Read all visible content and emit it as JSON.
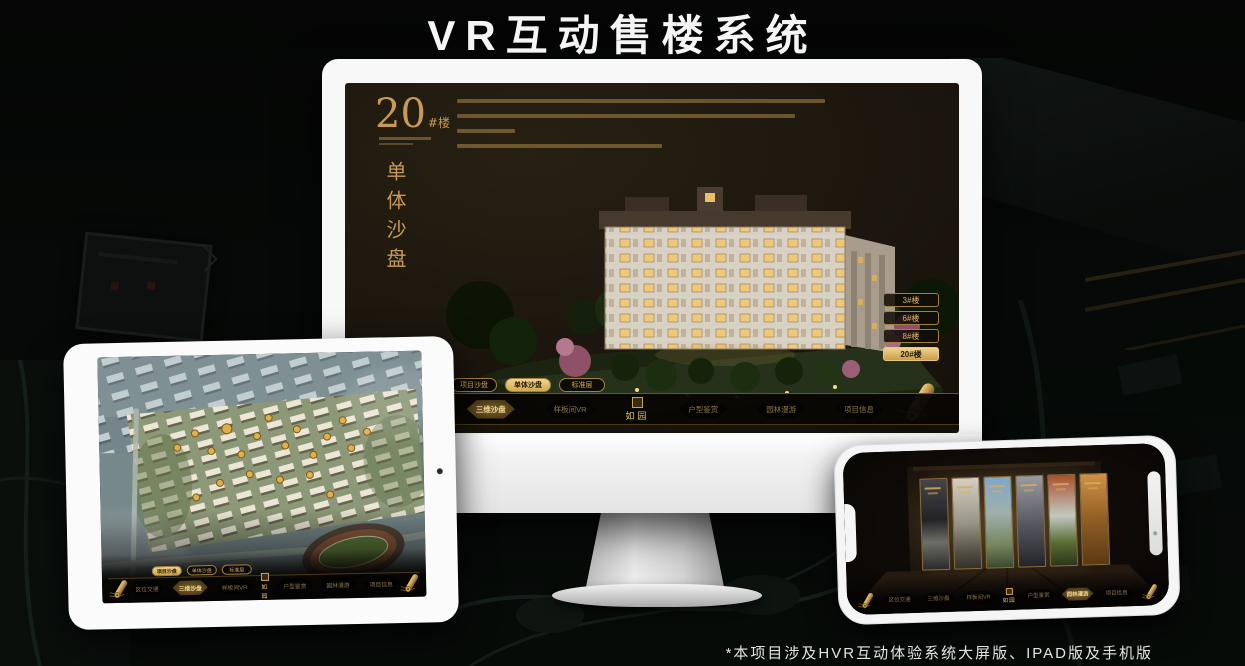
{
  "header": {
    "title": "VR互动售楼系统"
  },
  "footer": {
    "note": "*本项目涉及HVR互动体验系统大屏版、IPAD版及手机版"
  },
  "brand": {
    "name": "如园"
  },
  "colors": {
    "gold": "#c79a55",
    "gold_bright": "#f0d38c",
    "screen_brown": "#1c160e",
    "bezel_white": "#f8f8f8"
  },
  "monitor": {
    "heading_number": "20",
    "heading_unit": "#楼",
    "heading_vertical": "单体沙盘",
    "floor_buttons": [
      {
        "label": "3#楼",
        "active": false
      },
      {
        "label": "6#楼",
        "active": false
      },
      {
        "label": "8#楼",
        "active": false
      },
      {
        "label": "20#楼",
        "active": true
      }
    ],
    "mode_tabs": [
      {
        "label": "项目沙盘",
        "active": false
      },
      {
        "label": "单体沙盘",
        "active": true
      },
      {
        "label": "标准层",
        "active": false
      }
    ],
    "nav_items": [
      {
        "label": "区位交通",
        "active": false
      },
      {
        "label": "三维沙盘",
        "active": true
      },
      {
        "label": "样板间VR",
        "active": false
      },
      {
        "label": "户型鉴赏",
        "active": false
      },
      {
        "label": "园林漫游",
        "active": false
      },
      {
        "label": "项目信息",
        "active": false
      }
    ]
  },
  "tablet": {
    "mode_tabs": [
      {
        "label": "项目沙盘",
        "active": true
      },
      {
        "label": "单体沙盘",
        "active": false
      },
      {
        "label": "标准层",
        "active": false
      }
    ],
    "nav_items": [
      {
        "label": "区位交通",
        "active": false
      },
      {
        "label": "三维沙盘",
        "active": true
      },
      {
        "label": "样板间VR",
        "active": false
      },
      {
        "label": "户型鉴赏",
        "active": false
      },
      {
        "label": "园林漫游",
        "active": false
      },
      {
        "label": "项目信息",
        "active": false
      }
    ]
  },
  "phone": {
    "nav_items": [
      {
        "label": "区位交通",
        "active": false
      },
      {
        "label": "三维沙盘",
        "active": false
      },
      {
        "label": "样板间VR",
        "active": false
      },
      {
        "label": "户型鉴赏",
        "active": false
      },
      {
        "label": "园林漫游",
        "active": true
      },
      {
        "label": "项目信息",
        "active": false
      }
    ]
  }
}
